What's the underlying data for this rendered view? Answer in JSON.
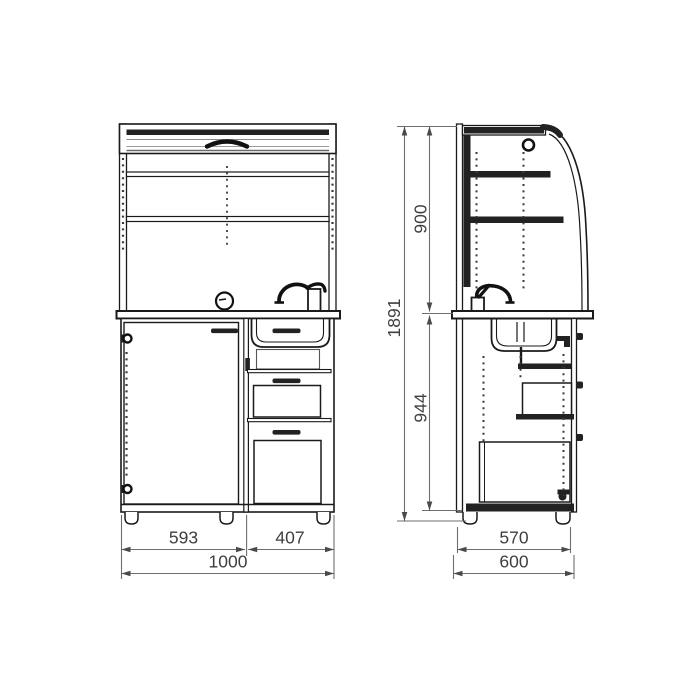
{
  "front_view": {
    "door_width_mm": "593",
    "drawer_width_mm": "407",
    "total_width_mm": "1000"
  },
  "side_view": {
    "upper_section_height_mm": "900",
    "lower_section_height_mm": "944",
    "total_height_mm": "1891",
    "body_depth_mm": "570",
    "total_depth_mm": "600"
  }
}
